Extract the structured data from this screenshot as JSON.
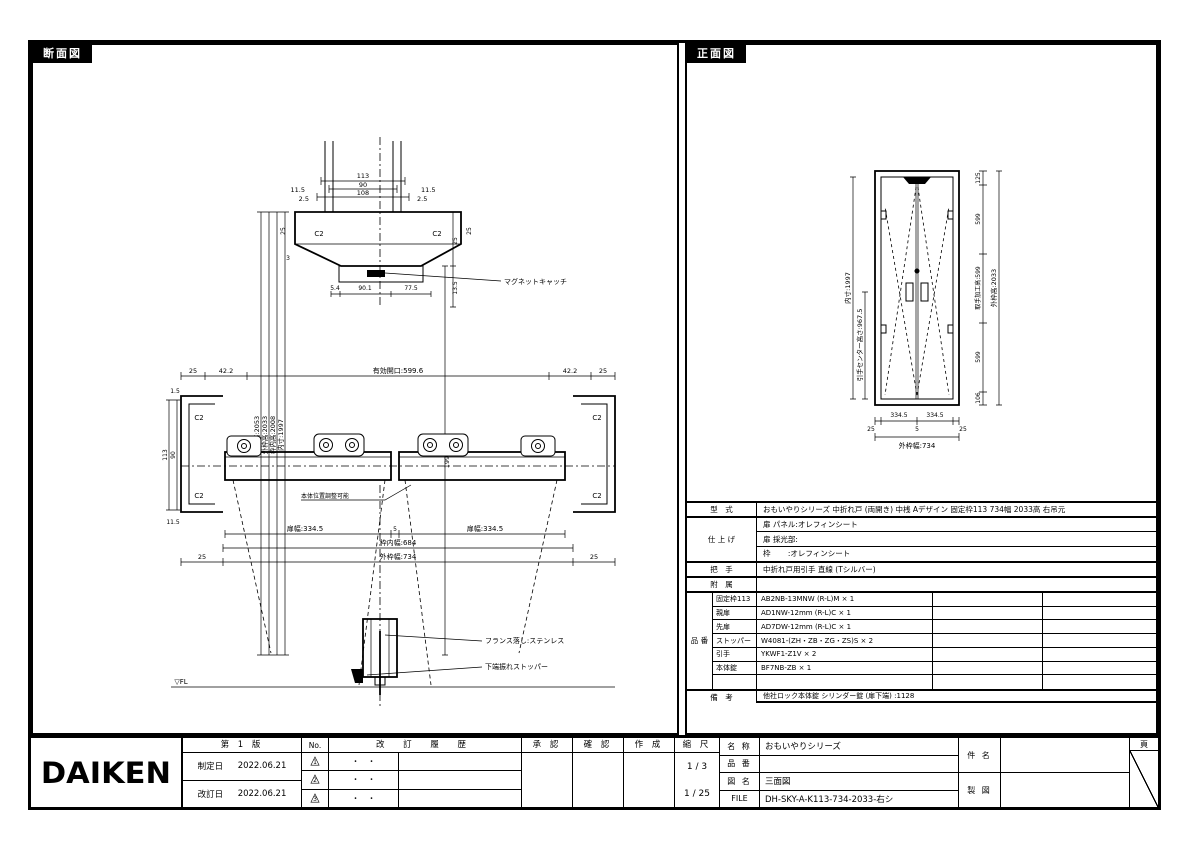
{
  "panels": {
    "section_tab": "断面図",
    "front_tab": "正面図"
  },
  "section": {
    "d113": "113",
    "d90": "90",
    "d108": "108",
    "d115l": "11.5",
    "d115r": "11.5",
    "d25l": "2.5",
    "d25r": "2.5",
    "c2tl": "C2",
    "c2tr": "C2",
    "r25l": "25",
    "r25r": "25",
    "d3": "3",
    "d54": "5.4",
    "d901": "90.1",
    "d775": "77.5",
    "magnet": "マグネットキャッチ",
    "v_opening": "開口高:2053",
    "v_outer": "外枠高:2033",
    "v_inner": "枠内高:2008",
    "v_leaf": "内寸:1997",
    "d1991": "1991",
    "r25": "25",
    "d135": "13.5",
    "m25l": "25",
    "m422l": "42.2",
    "m_eff": "有効開口:599.6",
    "m422r": "42.2",
    "m25r": "25",
    "d15": "1.5",
    "jv113": "113",
    "jv90": "90",
    "j115": "11.5",
    "c2ml": "C2",
    "c2mr": "C2",
    "c2bl": "C2",
    "c2br": "C2",
    "note": "本体位置調整可能",
    "leafw1": "扉幅:334.5",
    "gap5": "5",
    "leafw2": "扉幅:334.5",
    "innerw": "枠内幅:684",
    "outerw": "外枠幅:734",
    "b25l": "25",
    "b25r": "25",
    "french": "フランス落し:ステンレス",
    "stopper": "下端振れストッパー",
    "fl": "▽FL"
  },
  "front": {
    "v_leaf": "内寸:1997",
    "v_handle": "引手センター高さ:967.5",
    "s125": "125",
    "s599a": "599",
    "s_mid": "取手加工高:599",
    "s599b": "599",
    "s106": "106",
    "v_outer": "外枠高:2033",
    "b25l": "25",
    "b3345a": "334.5",
    "b5": "5",
    "b3345b": "334.5",
    "b25r": "25",
    "b_outer": "外枠幅:734"
  },
  "spec": {
    "model_label": "型　式",
    "model": "おもいやりシリーズ 中折れ戸 (両開き) 中桟 Aデザイン 固定枠113 734幅 2033高 右吊元",
    "finish_label": "仕 上 げ",
    "finish_rows": [
      "扉 パネル:オレフィンシート",
      "扉 採光部:",
      "枠　　 :オレフィンシート"
    ],
    "handle_label": "把　手",
    "handle": "中折れ戸用引手 直線 (Tシルバー)",
    "acc_label": "附　属",
    "acc": "",
    "parts_label": "品 番",
    "parts": [
      {
        "name": "固定枠113",
        "code": "AB2NB-13MNW (R-L)M × 1"
      },
      {
        "name": "親扉",
        "code": "AD1NW-12mm (R-L)C × 1"
      },
      {
        "name": "先扉",
        "code": "AD7DW-12mm (R-L)C × 1"
      },
      {
        "name": "ストッパー",
        "code": "W4081-(ZH・ZB・ZG・ZS)S × 2"
      },
      {
        "name": "引手",
        "code": "YKWF1-Z1V × 2"
      },
      {
        "name": "本体錠",
        "code": "BF7NB-ZB × 1"
      },
      {
        "name": "",
        "code": ""
      }
    ],
    "remarks_label": "備　考",
    "remarks": [
      "他社ロック本体錠 シリンダー錠 (扉下端) :1128",
      "",
      ""
    ]
  },
  "title_block": {
    "logo": "DAIKEN",
    "edition": "第 1 版",
    "established_label": "制定日",
    "established": "2022.06.21",
    "revised_label": "改訂日",
    "revised": "2022.06.21",
    "no_header": "No.",
    "history_header": "改 訂 履 歴",
    "rev_triangle": "△",
    "rev_marks": [
      "1",
      "2",
      "3"
    ],
    "rev_date_placeholder": "・　・",
    "approve_label": "承 認",
    "check_label": "確 認",
    "create_label": "作 成",
    "scale_label": "縮 尺",
    "scale1": "1 / 3",
    "scale2": "1 / 25",
    "name_label": "名 称",
    "name": "おもいやりシリーズ",
    "item_label": "品 番",
    "item": "",
    "dwg_label": "図 名",
    "dwg": "三面図",
    "file_label": "FILE",
    "file": "DH-SKY-A-K113-734-2033-右シ",
    "subject_label": "件 名",
    "subject": "",
    "draft_label": "製 図",
    "draft": "",
    "page_label": "頁"
  }
}
